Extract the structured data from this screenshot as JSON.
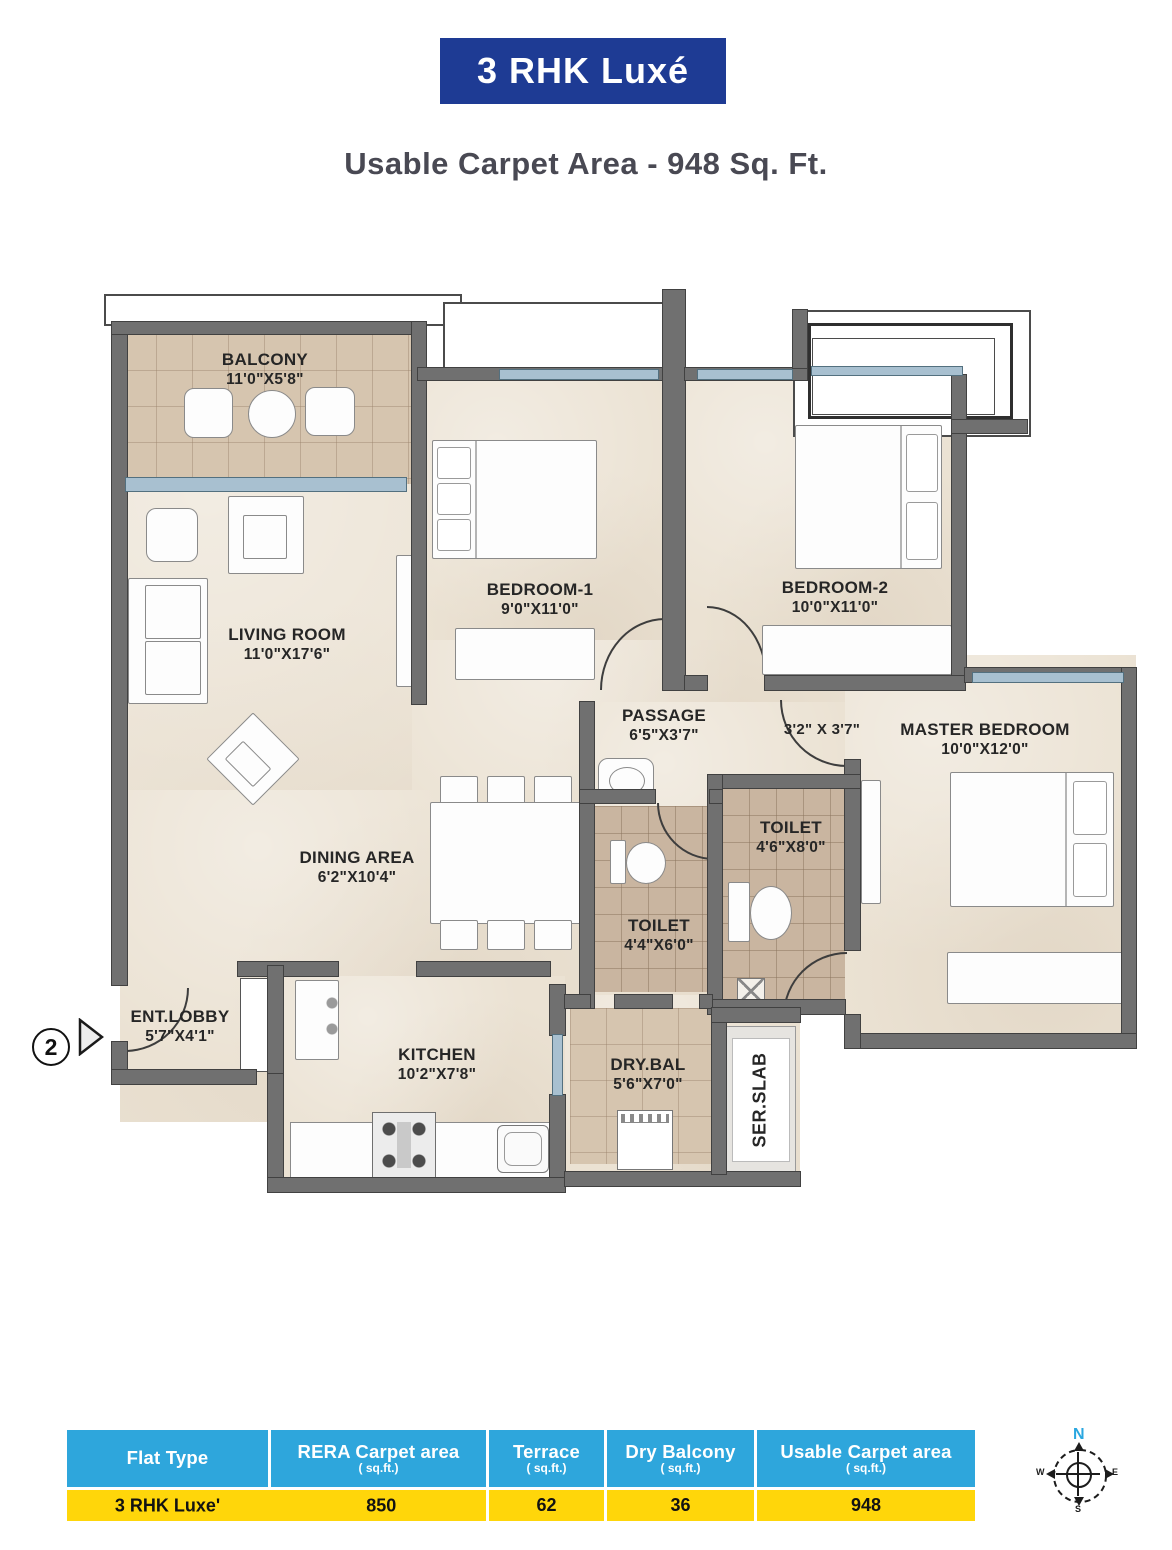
{
  "title": "3 RHK Luxé",
  "subtitle": "Usable Carpet Area - 948 Sq. Ft.",
  "entry": {
    "number": "2"
  },
  "rooms": {
    "balcony": {
      "name": "BALCONY",
      "dims": "11'0\"X5'8\""
    },
    "living": {
      "name": "LIVING ROOM",
      "dims": "11'0\"X17'6\""
    },
    "bedroom1": {
      "name": "BEDROOM-1",
      "dims": "9'0\"X11'0\""
    },
    "bedroom2": {
      "name": "BEDROOM-2",
      "dims": "10'0\"X11'0\""
    },
    "master": {
      "name": "MASTER BEDROOM",
      "dims": "10'0\"X12'0\""
    },
    "passage": {
      "name": "PASSAGE",
      "dims": "6'5\"X3'7\""
    },
    "passage2": {
      "dims": "3'2\" X 3'7\""
    },
    "toilet1": {
      "name": "TOILET",
      "dims": "4'6\"X8'0\""
    },
    "toilet2": {
      "name": "TOILET",
      "dims": "4'4\"X6'0\""
    },
    "dining": {
      "name": "DINING AREA",
      "dims": "6'2\"X10'4\""
    },
    "lobby": {
      "name": "ENT.LOBBY",
      "dims": "5'7\"X4'1\""
    },
    "kitchen": {
      "name": "KITCHEN",
      "dims": "10'2\"X7'8\""
    },
    "drybal": {
      "name": "DRY.BAL",
      "dims": "5'6\"X7'0\""
    },
    "serslab": {
      "name": "SER.SLAB"
    }
  },
  "compass": {
    "north": "N",
    "east": "E",
    "south": "S",
    "west": "W"
  },
  "table": {
    "headers": [
      {
        "label": "Flat Type",
        "sub": ""
      },
      {
        "label": "RERA Carpet area",
        "sub": "( sq.ft.)"
      },
      {
        "label": "Terrace",
        "sub": "( sq.ft.)"
      },
      {
        "label": "Dry Balcony",
        "sub": "( sq.ft.)"
      },
      {
        "label": "Usable Carpet area",
        "sub": "( sq.ft.)"
      }
    ],
    "row": [
      "3 RHK  Luxe'",
      "850",
      "62",
      "36",
      "948"
    ]
  },
  "colors": {
    "title_bg": "#1e3b94",
    "header_bg": "#2ea6dc",
    "row_bg": "#ffd60a",
    "wall": "#707070",
    "floor": "#ebe2d3",
    "window": "#a8c0d0",
    "north_letter": "#2aa7e0"
  }
}
